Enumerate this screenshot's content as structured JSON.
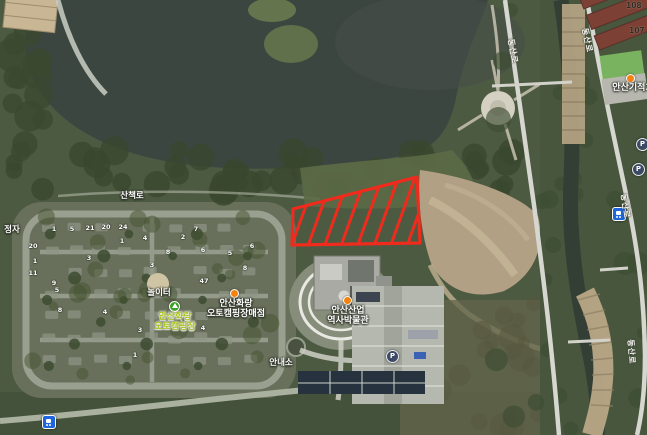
{
  "annotation": {
    "points": "293,209 417,177 420,243 292,245",
    "color": "#ee2b1c",
    "hatch": {
      "count": 8,
      "spacing": 16.5,
      "slant": 28
    }
  },
  "labels": {
    "trail": "산책로",
    "pavilion": "정자",
    "playground": "놀이터",
    "info_office": "안내소",
    "campground": {
      "line1": "안산화랑",
      "line2": "오토캠핑장"
    },
    "store": {
      "line1": "안산화랑",
      "line2": "오토캠핑장매점"
    },
    "museum": {
      "line1": "안산산업",
      "line2": "역사박물관"
    },
    "stream_poi": "안산기적3"
  },
  "road_names": [
    {
      "text": "동산로",
      "x": 516,
      "y": 38,
      "rot": 80
    },
    {
      "text": "동산로",
      "x": 590,
      "y": 27,
      "rot": 78
    },
    {
      "text": "동산로",
      "x": 629,
      "y": 193,
      "rot": 82
    },
    {
      "text": "동산로",
      "x": 636,
      "y": 339,
      "rot": 86
    }
  ],
  "building_numbers": [
    {
      "text": "108",
      "x": 626,
      "y": 1
    },
    {
      "text": "107",
      "x": 629,
      "y": 26
    }
  ],
  "site_numbers": [
    {
      "n": "1",
      "x": 54,
      "y": 229
    },
    {
      "n": "5",
      "x": 72,
      "y": 229
    },
    {
      "n": "21",
      "x": 90,
      "y": 228
    },
    {
      "n": "20",
      "x": 106,
      "y": 227
    },
    {
      "n": "24",
      "x": 123,
      "y": 227
    },
    {
      "n": "7",
      "x": 196,
      "y": 229
    },
    {
      "n": "4",
      "x": 145,
      "y": 238
    },
    {
      "n": "2",
      "x": 183,
      "y": 237
    },
    {
      "n": "1",
      "x": 122,
      "y": 241
    },
    {
      "n": "20",
      "x": 33,
      "y": 246
    },
    {
      "n": "6",
      "x": 252,
      "y": 246
    },
    {
      "n": "6",
      "x": 203,
      "y": 250
    },
    {
      "n": "8",
      "x": 168,
      "y": 252
    },
    {
      "n": "5",
      "x": 230,
      "y": 253
    },
    {
      "n": "3",
      "x": 89,
      "y": 258
    },
    {
      "n": "1",
      "x": 35,
      "y": 261
    },
    {
      "n": "3",
      "x": 152,
      "y": 265
    },
    {
      "n": "8",
      "x": 245,
      "y": 268
    },
    {
      "n": "11",
      "x": 33,
      "y": 273
    },
    {
      "n": "47",
      "x": 204,
      "y": 281
    },
    {
      "n": "9",
      "x": 54,
      "y": 283
    },
    {
      "n": "5",
      "x": 57,
      "y": 290
    },
    {
      "n": "8",
      "x": 60,
      "y": 310
    },
    {
      "n": "4",
      "x": 105,
      "y": 312
    },
    {
      "n": "3",
      "x": 140,
      "y": 330
    },
    {
      "n": "4",
      "x": 203,
      "y": 328
    },
    {
      "n": "1",
      "x": 135,
      "y": 355
    }
  ],
  "icons": {
    "parking_glyph": "P"
  }
}
